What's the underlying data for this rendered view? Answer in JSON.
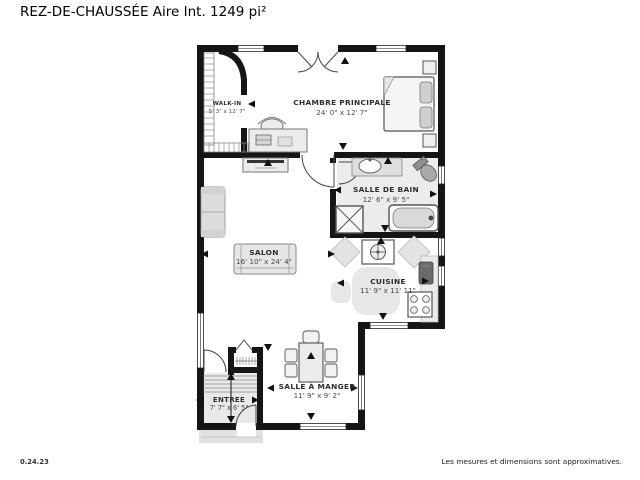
{
  "title": "REZ-DE-CHAUSSÉE Aire Int. 1249 pi²",
  "footer": {
    "left": "0.24.23",
    "right": "Les mesures et dimensions sont approximatives."
  },
  "rooms": {
    "walk_in": {
      "name": "WALK-IN",
      "dims": "5' 3\" x 12' 7\""
    },
    "chambre_principale": {
      "name": "CHAMBRE PRINCIPALE",
      "dims": "24' 0\" x 12' 7\""
    },
    "salle_de_bain": {
      "name": "SALLE DE BAIN",
      "dims": "12' 6\" x 9' 5\""
    },
    "salon": {
      "name": "SALON",
      "dims": "16' 10\" x 24' 4\""
    },
    "cuisine": {
      "name": "CUISINE",
      "dims": "11' 9\" x 11' 11\""
    },
    "salle_a_manger": {
      "name": "SALLE À MANGER",
      "dims": "11' 9\" x 9' 2\""
    },
    "entree": {
      "name": "ENTREE",
      "dims": "7' 7\" x 6' 5\""
    }
  },
  "colors": {
    "wall": "#151515",
    "furniture": "#ececec",
    "floor_shading": "#e9e9e9",
    "text": "#2d2d2d"
  }
}
